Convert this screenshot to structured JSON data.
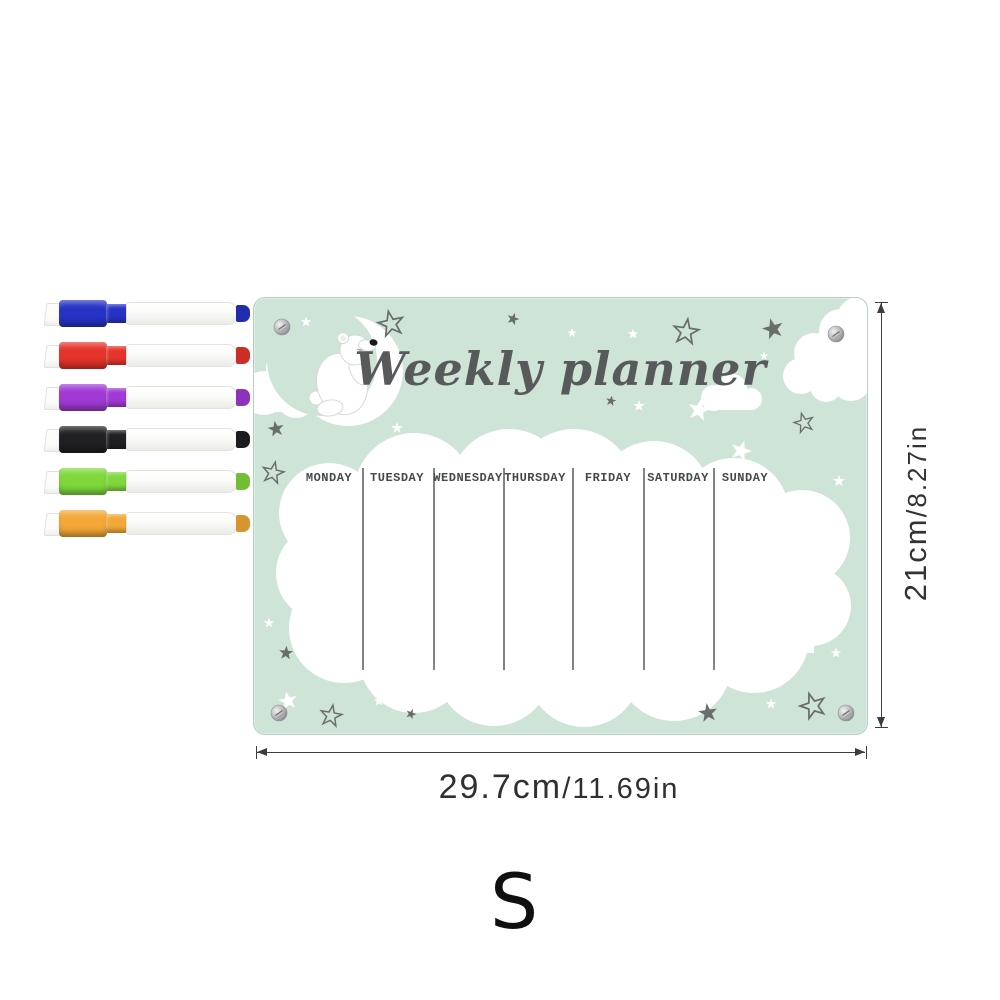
{
  "board": {
    "title": "Weekly planner",
    "days": [
      "MONDAY",
      "TUESDAY",
      "WEDNESDAY",
      "THURSDAY",
      "FRIDAY",
      "SATURDAY",
      "SUNDAY"
    ],
    "colors": {
      "background": "#cde4d7",
      "title": "#57595a",
      "star_gray": "#696e6b",
      "cloud_white": "#ffffff",
      "divider": "#565b59",
      "screw_silver": "#b9babc"
    }
  },
  "markers": [
    {
      "name": "blue",
      "color": "#2633c5"
    },
    {
      "name": "red",
      "color": "#e5342b"
    },
    {
      "name": "purple",
      "color": "#a139d6"
    },
    {
      "name": "black",
      "color": "#202022"
    },
    {
      "name": "green",
      "color": "#7fd83b"
    },
    {
      "name": "orange",
      "color": "#f4a837"
    }
  ],
  "dimensions": {
    "height_cm": "21cm",
    "height_in": "8.27in",
    "width_cm": "29.7cm",
    "width_in": "11.69in",
    "separator": "/"
  },
  "size_label": "S",
  "icons": {
    "star-filled": "★",
    "star-outline": "☆",
    "cloud": "☁",
    "moon": "🌙",
    "bear": "polar-bear",
    "screw": "●"
  }
}
